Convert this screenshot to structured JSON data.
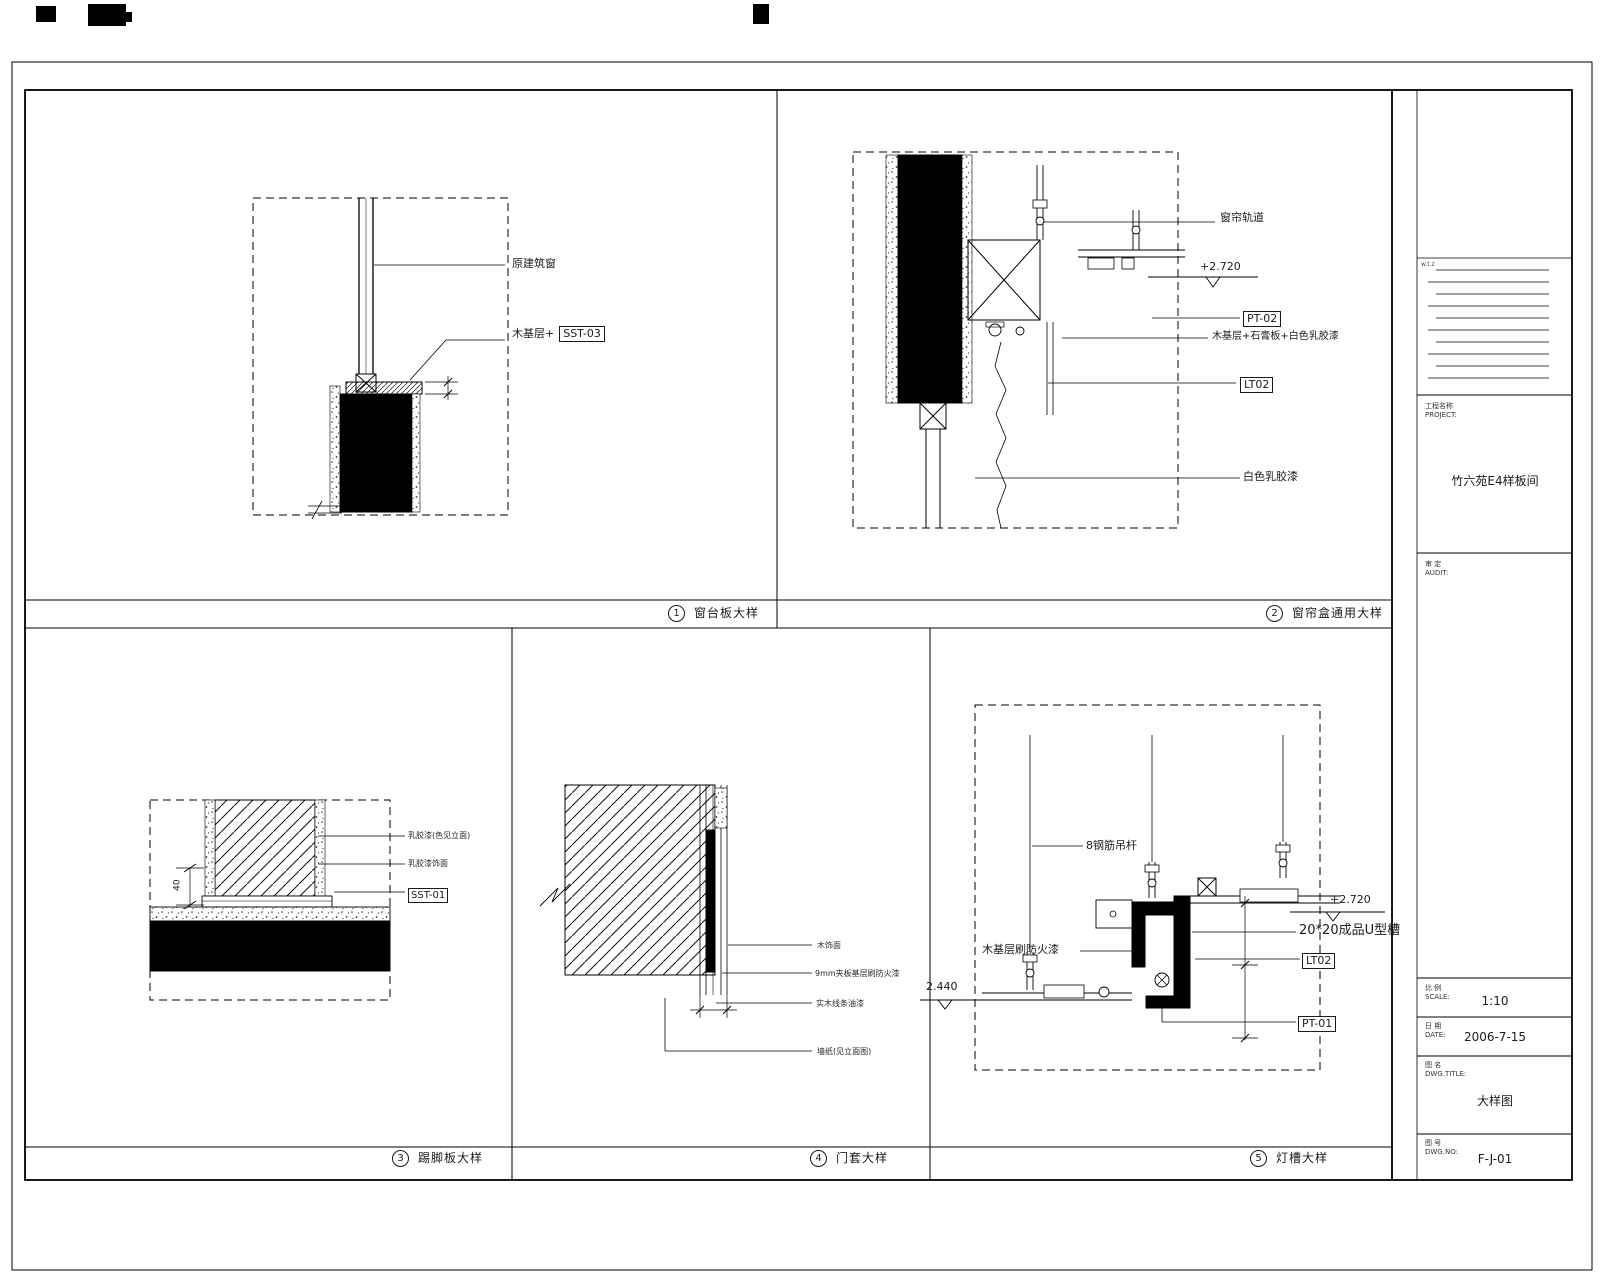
{
  "panels": {
    "p1": {
      "index": "1",
      "title": "窗台板大样",
      "labels": {
        "window": "原建筑窗",
        "base_prefix": "木基层+",
        "code": "SST-03"
      }
    },
    "p2": {
      "index": "2",
      "title": "窗帘盒通用大样",
      "labels": {
        "track": "窗帘轨道",
        "elev_top": "+2.720",
        "pt_code": "PT-02",
        "base": "木基层+石膏板+白色乳胶漆",
        "lt_code": "LT02",
        "paint": "白色乳胶漆"
      }
    },
    "p3": {
      "index": "3",
      "title": "踢脚板大样",
      "labels": {
        "wall_finish": "乳胶漆(色见立面)",
        "finish": "乳胶漆饰面",
        "code": "SST-01",
        "dim": "40"
      }
    },
    "p4": {
      "index": "4",
      "title": "门套大样",
      "labels": {
        "veneer": "木饰面",
        "plywood": "9mm夹板基层刷防火漆",
        "solidwood": "实木线条油漆",
        "wallpaper": "墙纸(见立面图)"
      }
    },
    "p5": {
      "index": "5",
      "title": "灯槽大样",
      "labels": {
        "rod": "8钢筋吊杆",
        "fireproof": "木基层刷防火漆",
        "uchannel": "20*20成品U型槽",
        "lt_code": "LT02",
        "pt_code": "PT-01",
        "elev_low": "2.440",
        "elev_top": "+2.720"
      }
    }
  },
  "titleblock": {
    "note": "w.t.z",
    "project_label": "工程名称",
    "project_label_en": "PROJECT:",
    "project_name": "竹六苑E4样板间",
    "audit_label": "审 定",
    "audit_label_en": "AUDIT:",
    "scale_label": "比 例",
    "scale_label_en": "SCALE:",
    "scale_value": "1:10",
    "date_label": "日 期",
    "date_label_en": "DATE:",
    "date_value": "2006-7-15",
    "name_label": "图 名",
    "name_label_en": "DWG.TITLE:",
    "name_value": "大样图",
    "no_label": "图 号",
    "no_label_en": "DWG.NO:",
    "no_value": "F-J-01"
  }
}
